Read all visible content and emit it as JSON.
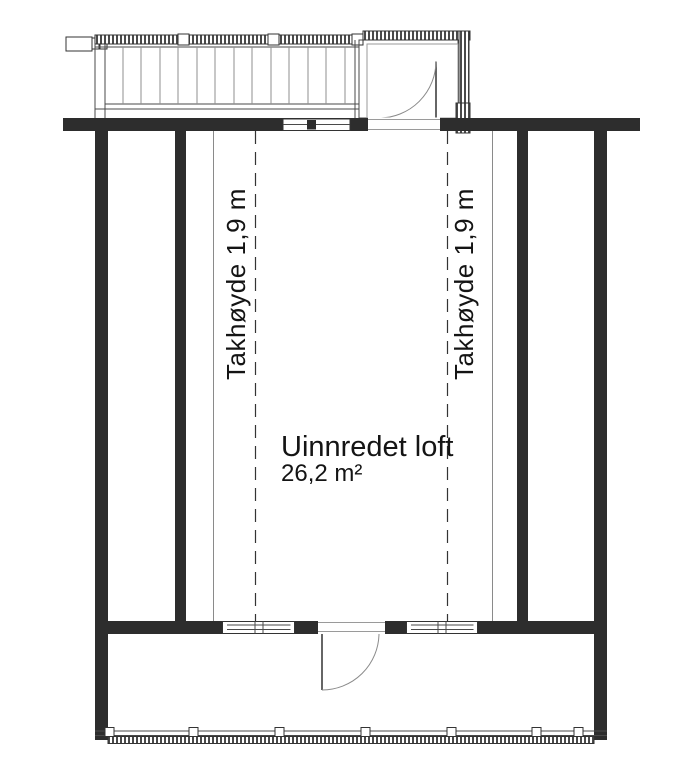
{
  "plan": {
    "room": {
      "name": "Uinnredet loft",
      "area": "26,2 m²"
    },
    "labels": {
      "ceiling_left": "Takhøyde 1,9 m",
      "ceiling_right": "Takhøyde 1,9 m"
    },
    "colors": {
      "wall": "#2d2d2d",
      "thin_line": "#4a4a4a",
      "light_line": "#9a9a9a",
      "dash_line": "#343434",
      "text": "#141414",
      "background": "#ffffff"
    }
  }
}
